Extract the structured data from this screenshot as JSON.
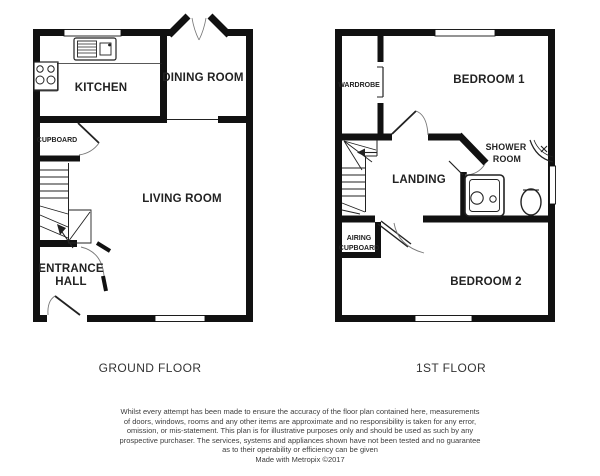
{
  "ground_floor": {
    "title": "GROUND FLOOR",
    "labels": {
      "kitchen": "KITCHEN",
      "dining_room": "DINING ROOM",
      "cupboard": "CUPBOARD",
      "living_room": "LIVING ROOM",
      "entrance_hall_line1": "ENTRANCE",
      "entrance_hall_line2": "HALL"
    }
  },
  "first_floor": {
    "title": "1ST FLOOR",
    "labels": {
      "wardrobe": "WARDROBE",
      "bedroom1": "BEDROOM 1",
      "shower_room_line1": "SHOWER",
      "shower_room_line2": "ROOM",
      "landing": "LANDING",
      "airing_cupboard_line1": "AIRING",
      "airing_cupboard_line2": "CUPBOARD",
      "bedroom2": "BEDROOM 2"
    }
  },
  "footer": {
    "disclaimer_lines": [
      "Whilst every attempt has been made to ensure the accuracy of the floor plan contained here, measurements",
      "of doors, windows, rooms and any other items are approximate and no responsibility is taken for any error,",
      "omission, or mis-statement. This plan is for illustrative purposes only and should be used as such by any",
      "prospective purchaser. The services, systems and appliances shown have not been tested and no guarantee",
      "as to their operability or efficiency can be given"
    ],
    "credit": "Made with Metropix ©2017"
  },
  "colors": {
    "wall": "#111111",
    "text": "#222222",
    "muted_text": "#3d3d3d",
    "background": "#ffffff"
  }
}
